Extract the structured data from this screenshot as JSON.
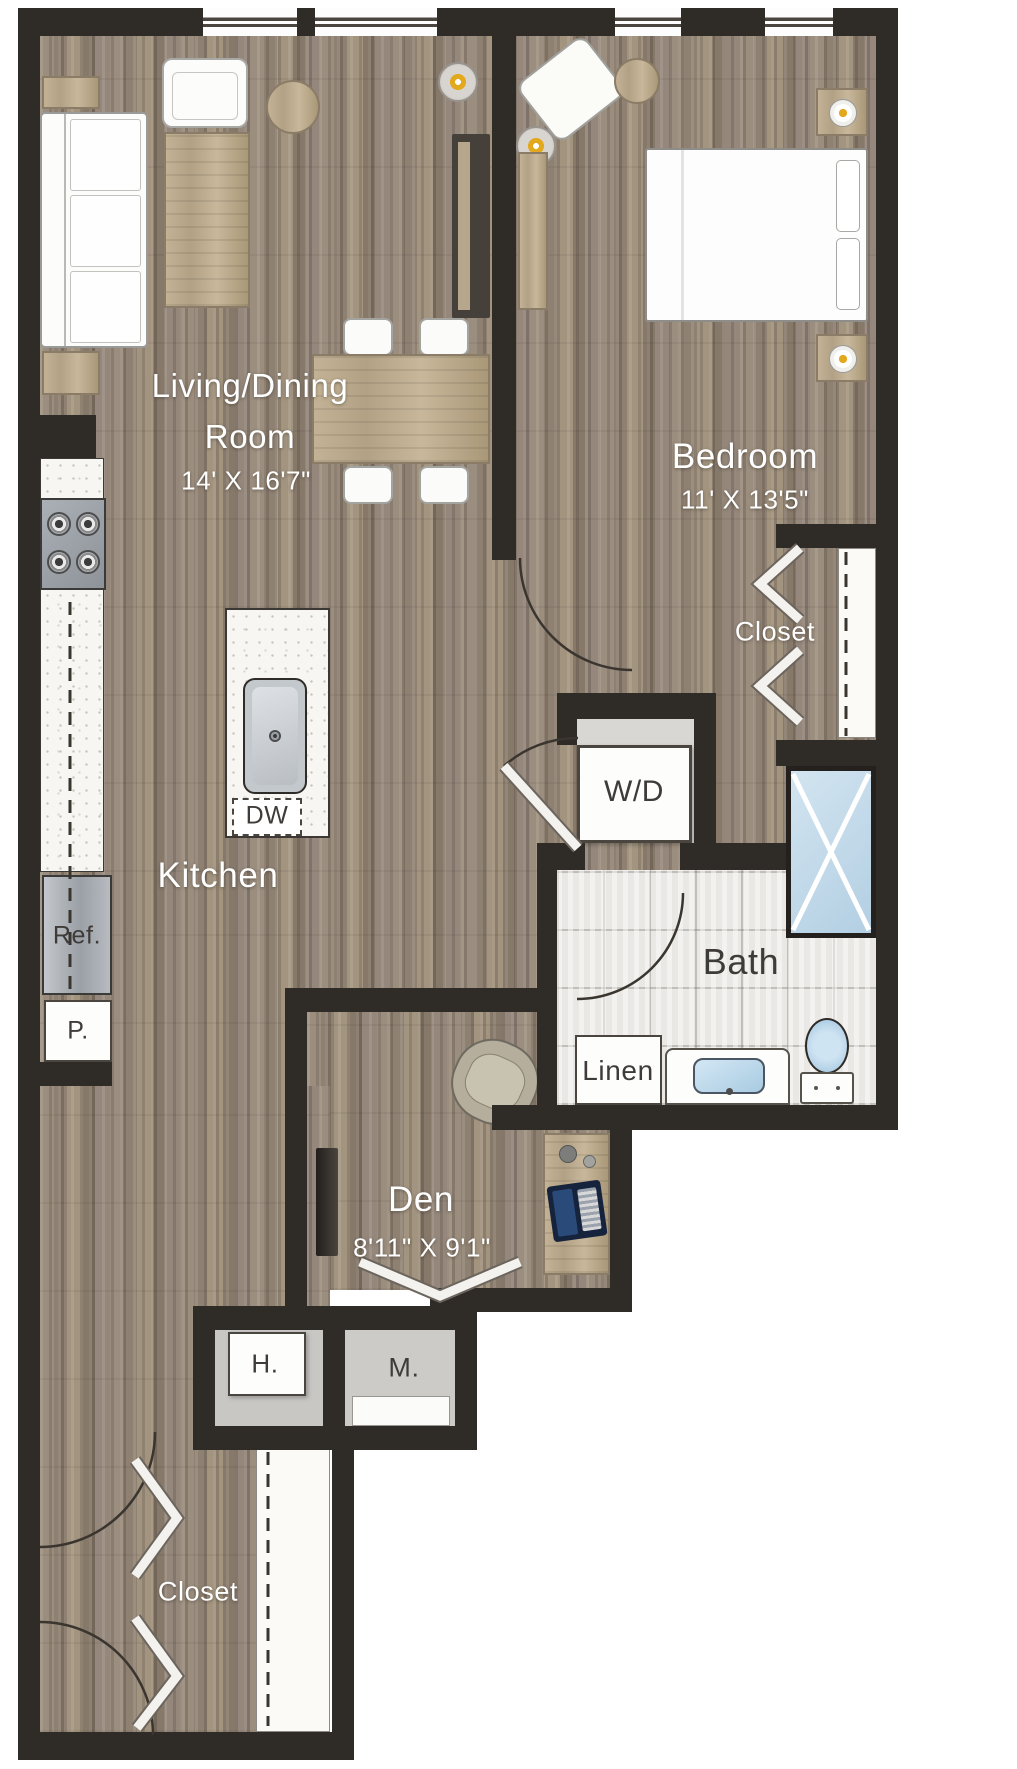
{
  "plan": {
    "rooms": {
      "living_dining": {
        "label_line1": "Living/Dining",
        "label_line2": "Room",
        "dims": "14' X 16'7\""
      },
      "bedroom": {
        "label": "Bedroom",
        "dims": "11' X 13'5\""
      },
      "kitchen": {
        "label": "Kitchen"
      },
      "bath": {
        "label": "Bath"
      },
      "den": {
        "label": "Den",
        "dims": "8'11\" X 9'1\""
      },
      "bedroom_closet": {
        "label": "Closet"
      },
      "entry_closet": {
        "label": "Closet"
      }
    },
    "fixtures": {
      "washer_dryer": {
        "label": "W/D"
      },
      "dishwasher": {
        "label": "DW"
      },
      "refrigerator": {
        "label": "Ref."
      },
      "pantry": {
        "label": "P."
      },
      "linen": {
        "label": "Linen"
      },
      "h_closet": {
        "label": "H."
      },
      "m_closet": {
        "label": "M."
      }
    },
    "colors": {
      "wall": "#2f2b27",
      "wood_base": "#97897a",
      "tile": "#eae8e5",
      "fixture_white": "#fdfdfc",
      "accent_blue": "#bdd7ea",
      "label_light": "#ffffff",
      "label_dark": "#3f3b38"
    }
  }
}
